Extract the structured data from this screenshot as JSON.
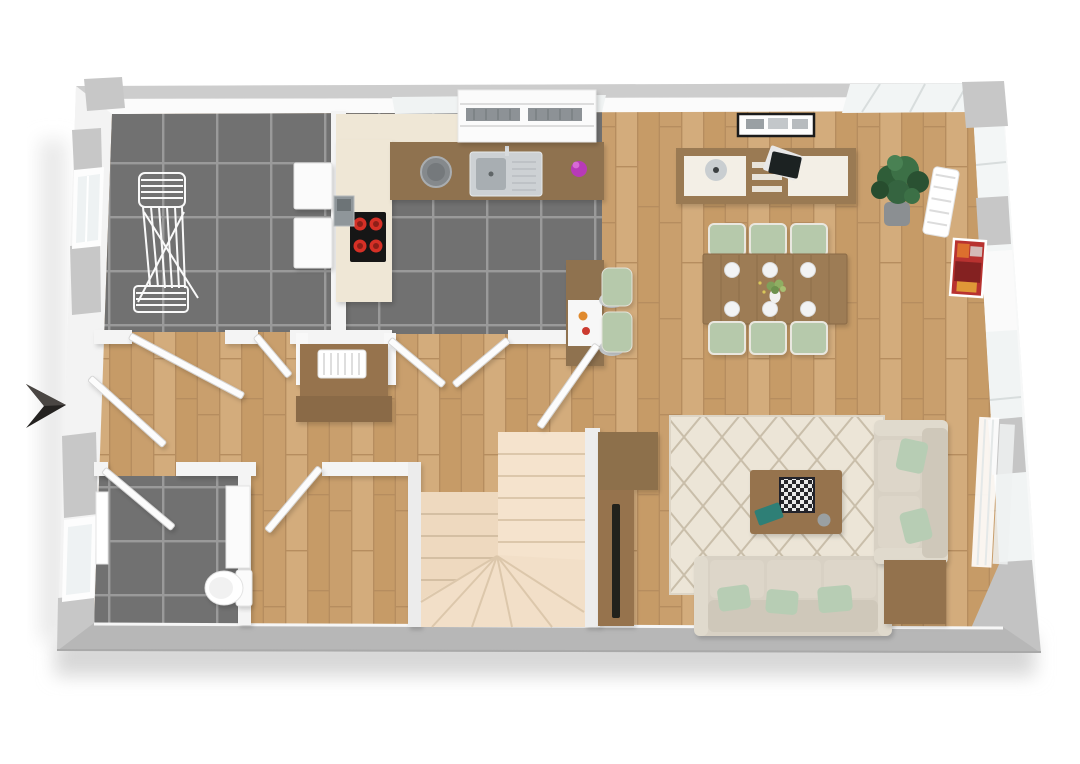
{
  "scene": {
    "type": "3d-floorplan-top-view",
    "description": "Rendered top-down 3D floor plan of a single storey apartment",
    "background": "#ffffff"
  },
  "colors": {
    "wall": "#f2f2f2",
    "wall_face": "#fbfbfb",
    "wall_cap": "#c7c7c7",
    "outer_band": "#b7b7b7",
    "tile": "#717171",
    "tile_grout": "#9a9a9a",
    "wood": "#cda573",
    "wood_line": "#b68d5f",
    "stair": "#f5e3cd",
    "stair_shade": "#eed9bf",
    "sofa": "#d8d1c4",
    "sofa_shade": "#cfc8ba",
    "pillow": "#b7cdb4",
    "chair_green": "#b6c9ab",
    "rug": "#ece5d7",
    "rug_line": "#c9beaa",
    "furniture_wood": "#96734d",
    "table_wood": "#9d7c54",
    "sideboard_wood": "#9a7a53",
    "counter_wood": "#8f7250",
    "cabinet_cream": "#efe7d6",
    "appliance_white": "#fbfbfb",
    "stove": "#161616",
    "burner": "#d63026",
    "bin": "#8f969a",
    "bowl": "#85898c",
    "sink": "#cdd1d4",
    "purple": "#b83ab8",
    "teal": "#2e7f76",
    "art_red": "#b83230",
    "plant": "#2f5d38",
    "pot": "#8b8f92",
    "tv": "#20201f",
    "arrow": "#242220",
    "door": "#fcfcfc",
    "glass": "#eef2f3",
    "shadow": "#d8d8d8"
  },
  "entrance_arrow": {
    "direction": "right",
    "meaning": "main-entrance"
  },
  "rooms": [
    {
      "id": "laundry-room",
      "floor": "dark-tile",
      "items": [
        "drying-rack",
        "washing-machine",
        "dryer",
        "window-left"
      ]
    },
    {
      "id": "kitchen",
      "floor": "dark-tile",
      "items": [
        "tall-cream-cabinets",
        "wood-countertop",
        "sink-with-drainer",
        "cooktop-4-burners",
        "metal-bin",
        "counter-bowl",
        "purple-jar",
        "window-shelf-unit",
        "breakfast-bar",
        "bar-stool",
        "bar-stool",
        "orange-fruit",
        "red-fruit"
      ]
    },
    {
      "id": "hallway",
      "floor": "wood",
      "items": [
        "console-table",
        "white-radiator"
      ]
    },
    {
      "id": "dining-area",
      "floor": "wood",
      "items": [
        "sideboard",
        "vase",
        "black-tablet",
        "wall-picture-frame",
        "dining-table",
        "dining-chair",
        "dining-chair",
        "dining-chair",
        "dining-chair",
        "dining-chair",
        "dining-chair",
        "place-plate",
        "place-plate",
        "place-plate",
        "place-plate",
        "place-plate",
        "place-plate",
        "centerpiece-plant",
        "potted-plant"
      ]
    },
    {
      "id": "living-area",
      "floor": "wood",
      "items": [
        "diamond-pattern-rug",
        "coffee-table",
        "chess-board",
        "teal-book",
        "coaster",
        "three-seat-sofa",
        "two-seat-sofa",
        "green-pillow",
        "green-pillow",
        "green-pillow",
        "green-pillow",
        "green-pillow",
        "corner-side-table",
        "tv-cabinet",
        "tv-bench",
        "flat-tv",
        "red-abstract-art",
        "wall-radiator",
        "wall-radiator",
        "sheer-curtains"
      ]
    },
    {
      "id": "bathroom",
      "floor": "dark-tile",
      "items": [
        "toilet",
        "vanity-cabinet",
        "white-radiator",
        "window-left"
      ]
    },
    {
      "id": "storage-room",
      "floor": "wood",
      "items": []
    },
    {
      "id": "staircase",
      "floor": "stairs",
      "items": [
        "u-shaped-winder-stairs"
      ]
    }
  ],
  "doors": [
    "entrance-door",
    "laundry-door",
    "hall-closet-door",
    "kitchen-door-left",
    "kitchen-door-right",
    "hall-living-door",
    "bathroom-door",
    "storage-door"
  ],
  "windows": [
    "laundry-window",
    "bathroom-window",
    "kitchen-top-window",
    "dining-corner-glazing",
    "living-right-window",
    "living-curtained-window"
  ]
}
